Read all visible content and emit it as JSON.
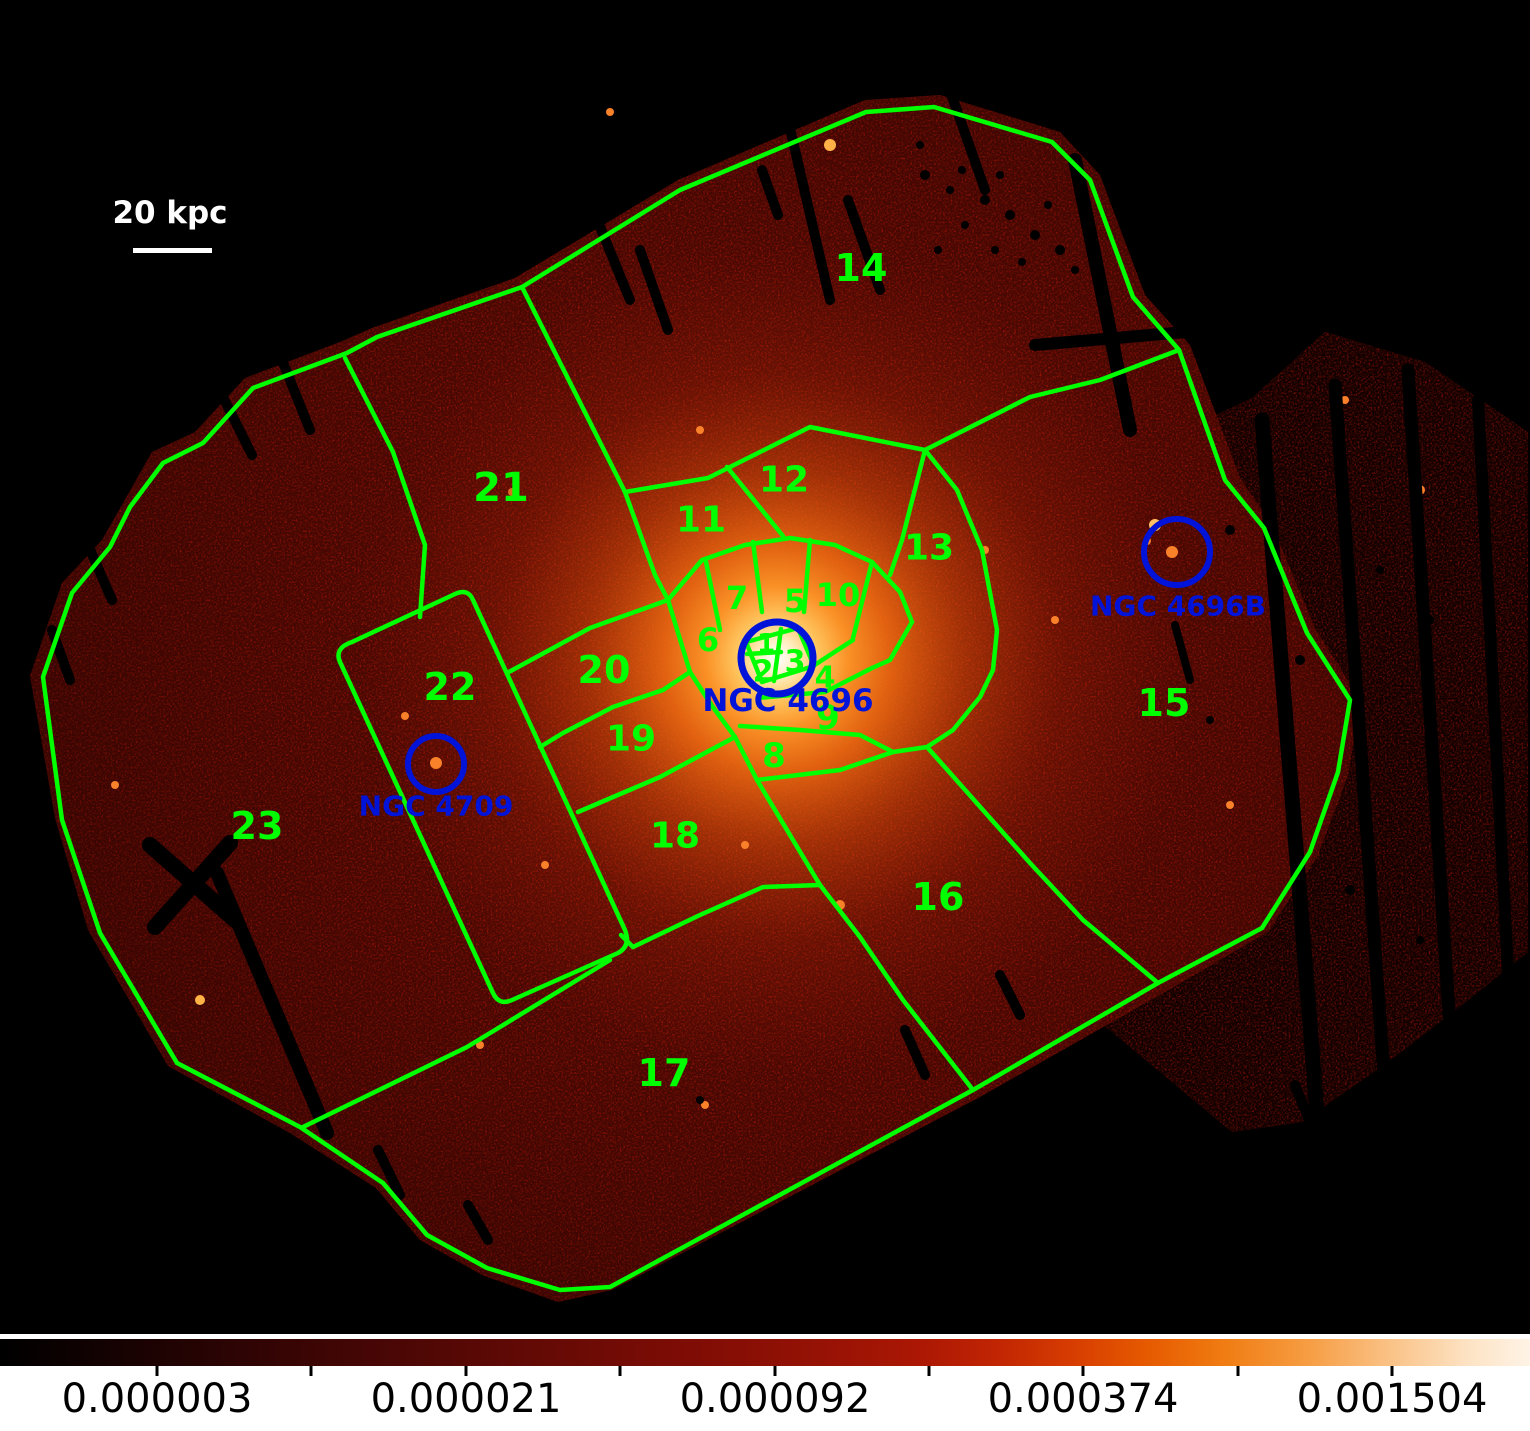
{
  "figure": {
    "scale_bar_label": "20 kpc",
    "regions": {
      "r1": "1",
      "r2": "2",
      "r3": "3",
      "r4": "4",
      "r5": "5",
      "r6": "6",
      "r7": "7",
      "r8": "8",
      "r9": "9",
      "r10": "10",
      "r11": "11",
      "r12": "12",
      "r13": "13",
      "r14": "14",
      "r15": "15",
      "r16": "16",
      "r17": "17",
      "r18": "18",
      "r19": "19",
      "r20": "20",
      "r21": "21",
      "r22": "22",
      "r23": "23"
    },
    "galaxies": {
      "center": "NGC 4696",
      "east": "NGC 4696B",
      "companion": "NGC 4709"
    },
    "colorbar": {
      "tick_labels": [
        "0.000003",
        "0.000021",
        "0.000092",
        "0.000374",
        "0.001504"
      ],
      "scale": "log",
      "colormap": "heat (black-red-orange-white)"
    },
    "colors": {
      "region_outline_green": "#00ff00",
      "galaxy_marker_blue": "#0013d9",
      "scalebar_white": "#ffffff",
      "background_black": "#000000",
      "field_red": "#8a1006",
      "core_white": "#ffffff"
    }
  }
}
